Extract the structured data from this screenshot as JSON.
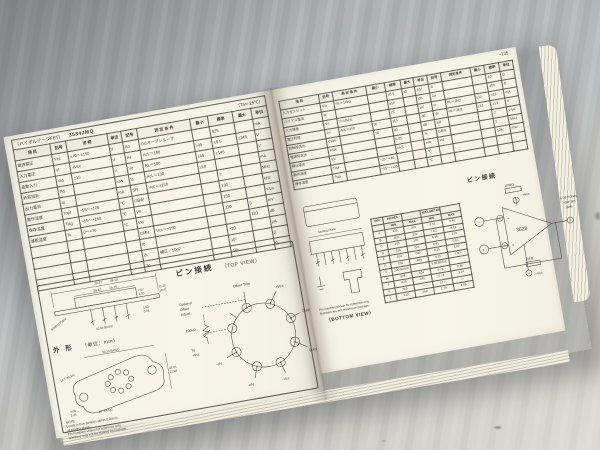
{
  "photo": {
    "subject": "open technical databook spread on gray table"
  },
  "left_page": {
    "model_label": "（ハイボルテージFET）",
    "model_number": "3584JMQ",
    "ta_note": "（Ta＝25℃）",
    "spec_table": {
      "header_rows": [
        [
          "項  目",
          "記号",
          "定  格",
          "単位",
          "記号",
          "測 定 条 件",
          "最小",
          "標準",
          "最大",
          "単位"
        ]
      ],
      "rows": [
        [
          "電源電圧",
          "Vcc",
          "±70～±150",
          "V",
          "Ao",
          "DCオープンループ",
          "",
          "625",
          "",
          "mA"
        ],
        [
          "入力電圧",
          "Vi",
          "±Vcc",
          "V",
          "Av",
          "AcL＝100",
          "≥45",
          "±6.5",
          "≤145",
          "V"
        ],
        [
          "差動入力",
          "Vid",
          "±15",
          "V",
          "Vo",
          "RL＝100",
          "±45",
          "±145",
          "",
          "V"
        ],
        [
          "許容損失",
          "Pd",
          "",
          "mW",
          "Io",
          "AcL＝100",
          "≥10",
          "",
          "",
          "mA"
        ],
        [
          "出力電流",
          "Io",
          "",
          "mA",
          "SR",
          "Vcc＝±150",
          "",
          "7",
          "",
          "MHz"
        ],
        [
          "動作温度",
          "Topr",
          "−55～+125",
          "℃",
          "GBW",
          "",
          "",
          "130",
          "",
          "kHz"
        ],
        [
          "保存温度",
          "Tstg",
          "−55～+150",
          "℃",
          "Vn",
          "",
          "",
          "150",
          "",
          "V/μs"
        ],
        [
          "基板温度",
          "Tc",
          "0～+70",
          "℃",
          "Vio",
          "",
          "",
          "110",
          "3",
          "mV"
        ],
        [
          "",
          "",
          "",
          "",
          "CMR",
          "Vcc＝±150",
          "",
          "",
          "110",
          "dB"
        ],
        [
          "",
          "",
          "",
          "",
          "Ib",
          "",
          "",
          "−20",
          "",
          "μA"
        ],
        [
          "",
          "",
          "",
          "",
          "Zi",
          "補正／10pF",
          "",
          "10⁵",
          "",
          "Ω"
        ],
        [
          "",
          "",
          "",
          "",
          "Zo",
          "",
          "",
          "10⁶",
          "",
          "Ω"
        ]
      ]
    },
    "pin_section": {
      "heading": "ピン接続",
      "view_label": "（TOP VIEW）",
      "pins": [
        "1",
        "2",
        "3",
        "4",
        "5",
        "6",
        "7",
        "8"
      ],
      "labels": {
        "adjust1": "Optional",
        "adjust2": "Offset",
        "adjust3": "Adjust",
        "pot": "100kΩ",
        "to1": "To",
        "to2": "+Vcc",
        "offset_trim": "Offset Trim",
        "vcc_plus": "+Vcc",
        "output": "Output",
        "common": "Common",
        "vcc_minus": "−Vcc",
        "in_plus": "+IN",
        "in_minus": "−IN"
      }
    },
    "outline_section": {
      "heading": "外  形",
      "unit_label": "（単位：mm）",
      "side": {
        "w": "39.37",
        "w2": "38.10",
        "capw": "26.67",
        "capw2": "25.15",
        "h": "11.18",
        "h2": "10.41",
        "caph": "2.67",
        "caph2": "2.03",
        "lead": "1.02",
        "lead2": "0.51",
        "seating": "Seating Plane",
        "pitch": "10.92 BASIC"
      },
      "bottom": {
        "span": "30.23 BASIC",
        "left_diag": "12.7 BASIC",
        "angle": "40° BASIC",
        "h": "22.23",
        "h2": "21.08",
        "pind": "4.06",
        "pind2": "3.43"
      },
      "note_lines": [
        "NOTE:",
        "Leads in true position within 0.25mm",
        "at seating plane.",
        "Pin numbers shown for reference only.",
        "Numbers may not be marked on package."
      ]
    }
  },
  "right_page": {
    "page_number": "−135",
    "char_table": {
      "header_rows": [
        [
          "項 目",
          "記号",
          "測 定 条 件",
          "最小",
          "標準",
          "最大",
          "単位",
          "記号",
          "測定条件",
          "最小",
          "標準",
          "単位"
        ]
      ],
      "rows": [
        [
          "入力オフセット",
          "Vio",
          "Rs＝10kΩ",
          "",
          "±0.5",
          "±2",
          "mV",
          "Zi",
          "",
          "",
          "10⁶",
          "Ω"
        ],
        [
          "バイアス電流",
          "Ib",
          "",
          "",
          "±10",
          "",
          "pA",
          "Zo",
          "",
          "",
          "300",
          "Ω"
        ],
        [
          "入力雑音",
          "Vn",
          "f＝10kHz",
          "",
          "25",
          "",
          "μV",
          "Io",
          "RL＝2kΩ",
          "±12",
          "±13",
          "mA"
        ],
        [
          "電圧利得",
          "Av",
          "AcL＝100",
          "90",
          "110",
          "",
          "dB",
          "Vo",
          "RL＝2kΩ",
          "±12",
          "±13",
          "V"
        ],
        [
          "同相除去比",
          "CMR",
          "",
          "70",
          "90",
          "",
          "dB",
          "SR",
          "",
          "",
          "2",
          "V/μs"
        ],
        [
          "電源除去比",
          "PSR",
          "",
          "",
          "0.05",
          "",
          "%",
          "GBW",
          "",
          "",
          "5",
          "MHz"
        ],
        [
          "静止電流",
          "Icc",
          "",
          "",
          "±4.5",
          "",
          "mA",
          "Pd",
          "",
          "",
          "128",
          "mW"
        ],
        [
          "動作温度",
          "Topr",
          "",
          "−25～+85",
          "",
          "",
          "℃",
          "",
          "",
          "",
          "",
          ""
        ],
        [
          "保存温度",
          "Tstg",
          "",
          "−55～+125",
          "",
          "",
          "℃",
          "",
          "",
          "",
          "",
          ""
        ]
      ]
    },
    "dim_table": {
      "header_rows": [
        [
          "DIM",
          "INCHES",
          "",
          "MILLIMETERS",
          ""
        ],
        [
          "",
          "MIN",
          "MAX",
          "MIN",
          "MAX"
        ]
      ],
      "rows": [
        [
          "A",
          ".335",
          ".370",
          "8.51",
          "9.40"
        ],
        [
          "B",
          ".300",
          ".320",
          "7.62",
          "8.13"
        ],
        [
          "C",
          ".165",
          ".185",
          "4.19",
          "4.70"
        ],
        [
          "D",
          ".016",
          ".021",
          "0.41",
          "0.53"
        ],
        [
          "E",
          ".010",
          ".040",
          "0.25",
          "1.02"
        ],
        [
          "F",
          ".010",
          ".040",
          "0.25",
          "1.02"
        ],
        [
          "G",
          ".200 BASIC",
          "",
          "5.08 BASIC",
          ""
        ],
        [
          "H",
          ".028",
          ".034",
          "0.71",
          "0.86"
        ],
        [
          "J",
          ".029",
          ".045",
          "0.74",
          "1.14"
        ],
        [
          "K",
          ".500",
          "—",
          "12.7",
          "—"
        ],
        [
          "L",
          ".110",
          ".160",
          "2.79",
          "4.06"
        ]
      ]
    },
    "pin_section": {
      "heading": "ピン接続",
      "amp_label": "3628",
      "labels": {
        "vcc_plus": "+Vcc",
        "vcc_minus": "−Vcc",
        "r1": "100kΩ",
        "r2": "10kΩ",
        "note1": "＊OPTIONAL",
        "note2": "OFFSET",
        "note3": "TRIM"
      }
    },
    "package_section": {
      "seating": "Seating Plane",
      "bottom_view": "（BOTTOM VIEW）",
      "note_lines": [
        "Pin numbers shown for reference only.",
        "Numbers are not marked on package."
      ]
    }
  }
}
